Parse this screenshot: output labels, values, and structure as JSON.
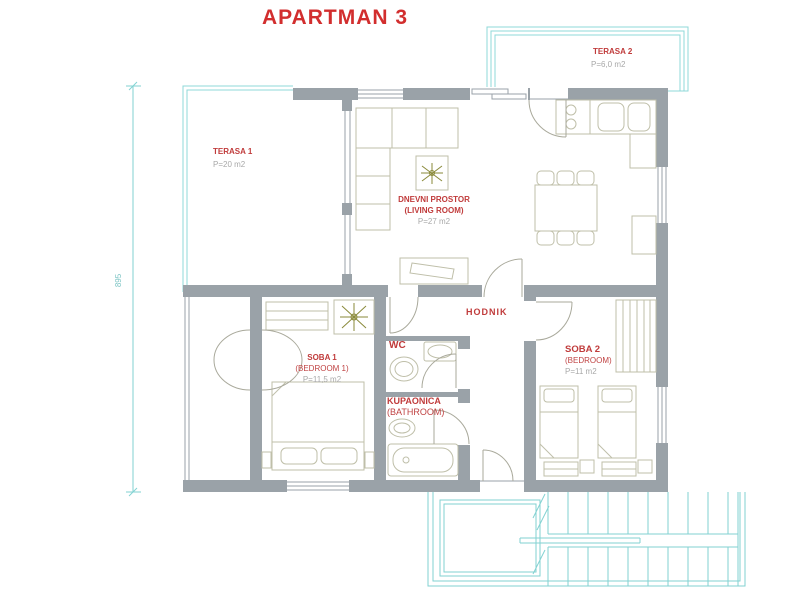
{
  "title": "APARTMAN 3",
  "dimension_label": "895",
  "rooms": {
    "terasa1": {
      "name": "TERASA 1",
      "area": "P=20 m2"
    },
    "terasa2": {
      "name": "TERASA 2",
      "area": "P=6,0 m2"
    },
    "living_room": {
      "name": "DNEVNI PROSTOR",
      "name_en": "(LIVING ROOM)",
      "area": "P=27 m2"
    },
    "hallway": {
      "name": "HODNIK"
    },
    "bedroom1": {
      "name": "SOBA 1",
      "name_en": "(BEDROOM 1)",
      "area": "P=11,5 m2"
    },
    "wc": {
      "name": "WC"
    },
    "bathroom": {
      "name": "KUPAONICA",
      "name_en": "(BATHROOM)"
    },
    "bedroom2": {
      "name": "SOBA 2",
      "name_en": "(BEDROOM)",
      "area": "P=11 m2"
    }
  },
  "colors": {
    "title_red": "#d22e2e",
    "label_red": "#c03b3b",
    "area_gray": "#a8a8a8",
    "wall_gray": "#9aa2a8",
    "terrace_cyan": "#82d2d2",
    "furniture_tan": "#bfbfa9"
  }
}
